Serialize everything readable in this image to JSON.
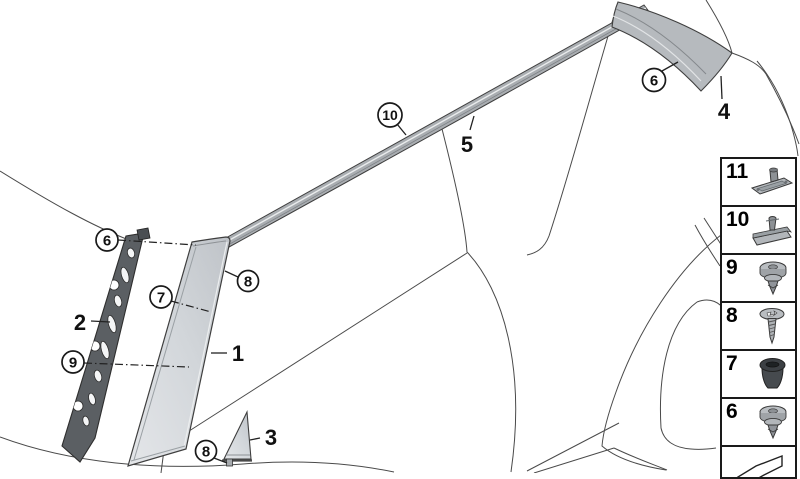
{
  "diagram": {
    "type": "exploded-parts-line-drawing",
    "subject": "car side window and pillar trim",
    "callouts": [
      {
        "label": "10",
        "style": "circled"
      },
      {
        "label": "5",
        "style": "plain"
      },
      {
        "label": "6",
        "style": "circled"
      },
      {
        "label": "4",
        "style": "plain"
      },
      {
        "label": "6",
        "style": "circled"
      },
      {
        "label": "7",
        "style": "circled"
      },
      {
        "label": "8",
        "style": "circled"
      },
      {
        "label": "2",
        "style": "plain"
      },
      {
        "label": "9",
        "style": "circled"
      },
      {
        "label": "1",
        "style": "plain"
      },
      {
        "label": "3",
        "style": "plain"
      },
      {
        "label": "8",
        "style": "circled"
      }
    ],
    "colors": {
      "background": "#ffffff",
      "body_line": "#4a4a4a",
      "panel_fill": "#ccd0d4",
      "bracket_fill": "#5b5f63",
      "strip_fill": "#a9adb1",
      "window_trim_fill": "#b6babe",
      "callout_stroke": "#1a1a1a"
    }
  },
  "sidebar": {
    "items": [
      {
        "number": "11",
        "icon": "mounting-rail-clip-icon"
      },
      {
        "number": "10",
        "icon": "mounting-clip-icon"
      },
      {
        "number": "9",
        "icon": "push-rivet-icon"
      },
      {
        "number": "8",
        "icon": "screw-icon"
      },
      {
        "number": "7",
        "icon": "rubber-grommet-icon"
      },
      {
        "number": "6",
        "icon": "push-rivet-icon"
      },
      {
        "number": "",
        "icon": "direction-arrow-icon"
      }
    ]
  }
}
